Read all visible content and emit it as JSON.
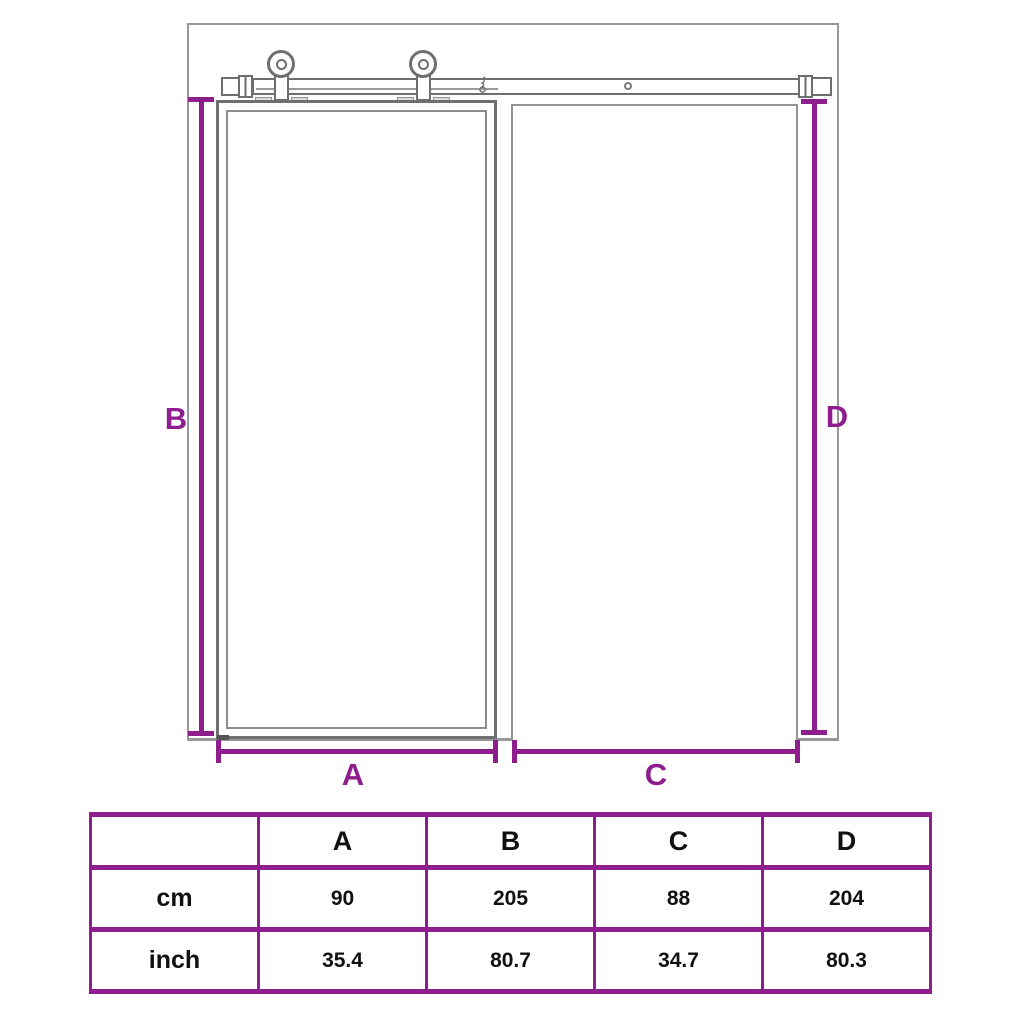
{
  "diagram": {
    "dimension_labels": {
      "a": "A",
      "b": "B",
      "c": "C",
      "d": "D"
    },
    "accent_color": "#8e1d8e",
    "line_color": "#6e6e6e"
  },
  "table": {
    "header": [
      "",
      "A",
      "B",
      "C",
      "D"
    ],
    "rows": [
      {
        "label": "cm",
        "values": [
          "90",
          "205",
          "88",
          "204"
        ]
      },
      {
        "label": "inch",
        "values": [
          "35.4",
          "80.7",
          "34.7",
          "80.3"
        ]
      }
    ]
  }
}
